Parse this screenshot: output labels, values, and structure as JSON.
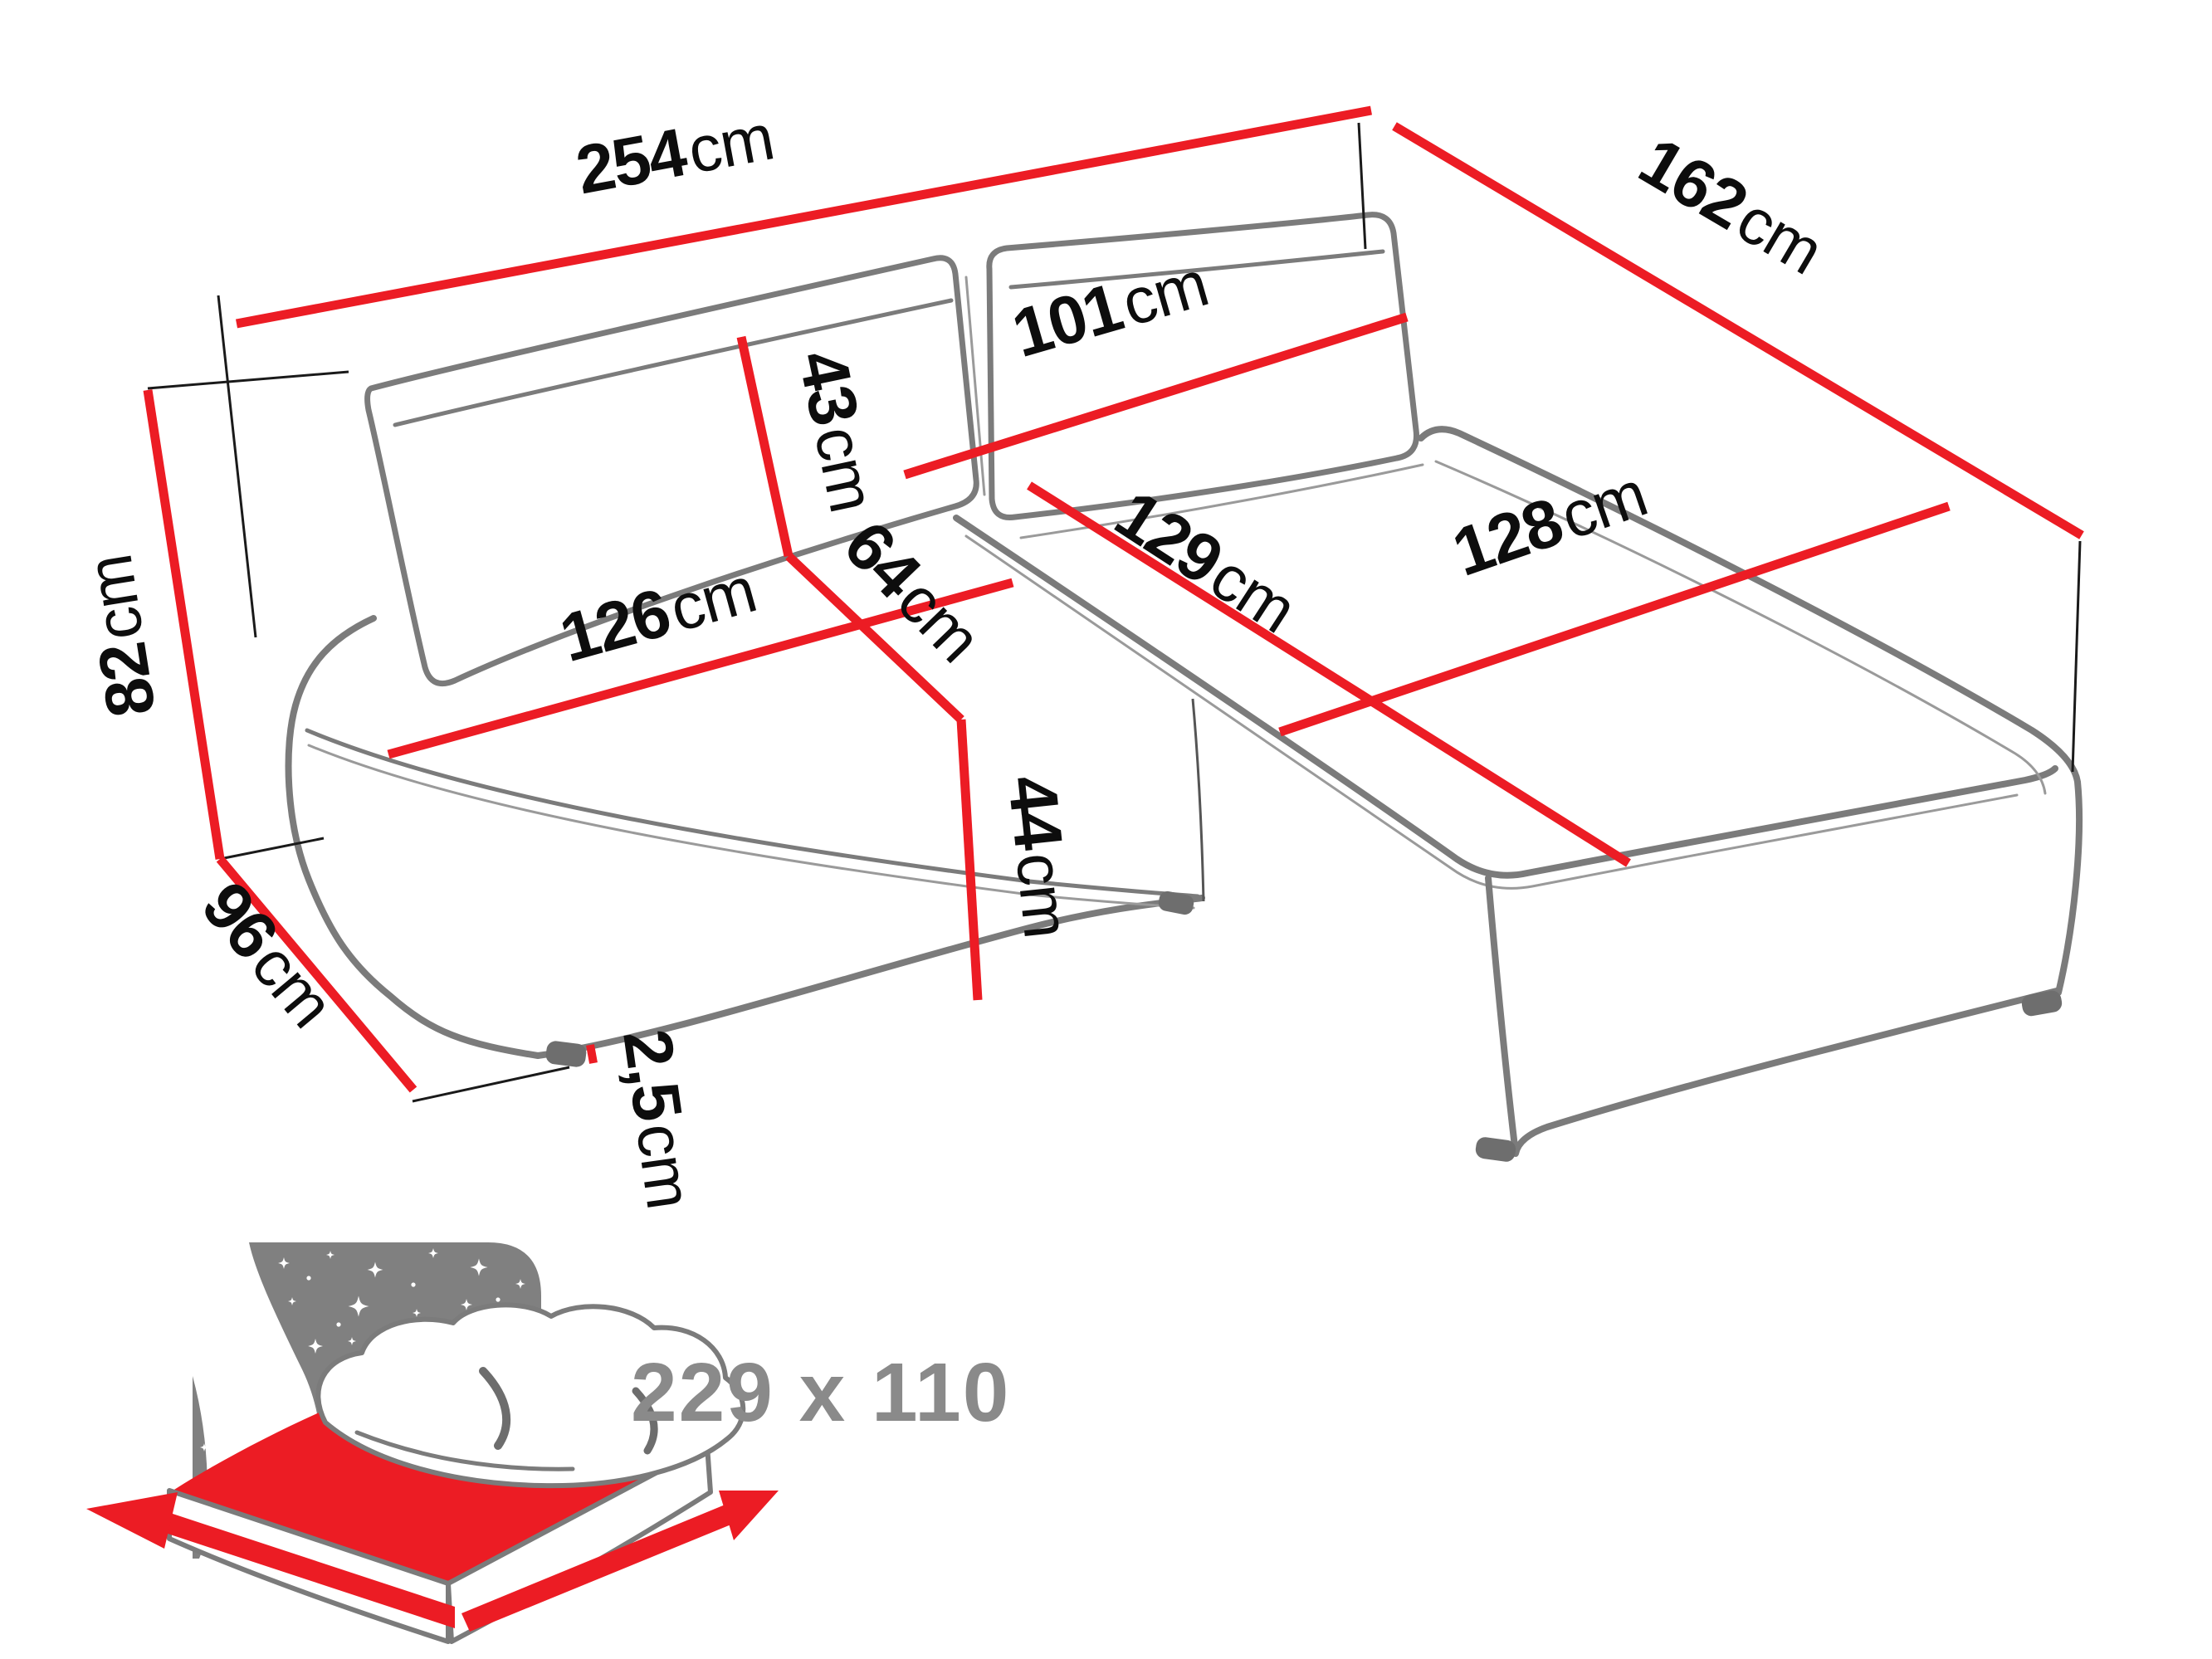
{
  "page": {
    "background": "#ffffff"
  },
  "diagram": {
    "type": "furniture-dimension-diagram",
    "subject": "corner-sofa-bed",
    "dims": {
      "d254": {
        "num": "254",
        "unit": "cm"
      },
      "d162": {
        "num": "162",
        "unit": "cm"
      },
      "d101": {
        "num": "101",
        "unit": "cm"
      },
      "d43": {
        "num": "43",
        "unit": "cm"
      },
      "d64": {
        "num": "64",
        "unit": "cm"
      },
      "d126": {
        "num": "126",
        "unit": "cm"
      },
      "d129": {
        "num": "129",
        "unit": "cm"
      },
      "d128": {
        "num": "128",
        "unit": "cm"
      },
      "d82": {
        "num": "82",
        "unit": "cm"
      },
      "d96": {
        "num": "96",
        "unit": "cm"
      },
      "d44": {
        "num": "44",
        "unit": "cm"
      },
      "d2_5": {
        "num": "2,5",
        "unit": "cm"
      }
    },
    "sleeping_area": {
      "size_label": "229 x 110"
    },
    "icons": {
      "sleeping_area_icon": "bed-under-night-sky"
    },
    "colors": {
      "dimension_line": "#ec1c24",
      "outline_gray": "#7b7b7b",
      "label_black": "#0d0d0d",
      "icon_panel_gray": "#808080",
      "icon_text_gray": "#8a8a8a"
    }
  }
}
